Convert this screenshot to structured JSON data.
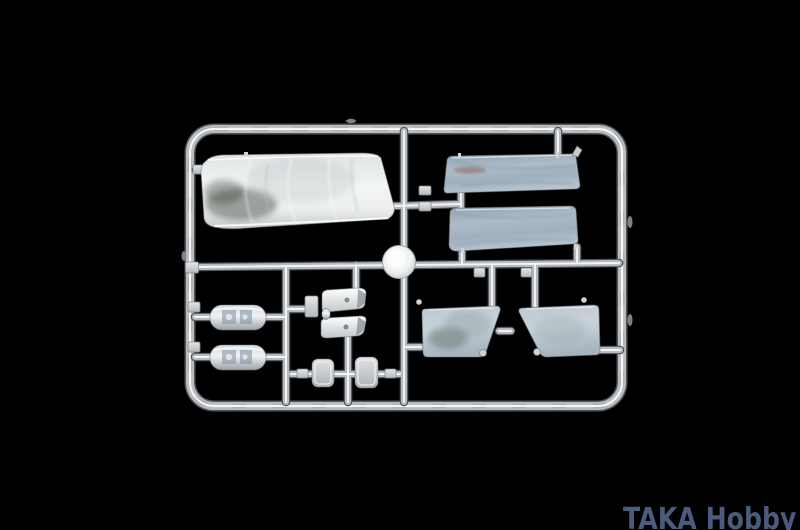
{
  "watermark": {
    "text": "TAKA Hobby"
  },
  "colors": {
    "background": "#000000",
    "watermark": "#4b5b7c",
    "plastic-base": "#b6babe",
    "plastic-highlight": "#f2f5f6",
    "glass-tint": "#a9b7c4",
    "window-tint": "#b9c6d1"
  },
  "photo": {
    "subject": "clear plastic model-kit sprue of transparent parts on black background",
    "parts": [
      "sprue-frame",
      "center-boss",
      "windshield",
      "upper-window-pane",
      "lower-window-pane",
      "lens-strip-top",
      "lens-strip-bottom",
      "visor-upper",
      "visor-lower",
      "glass-block-left",
      "glass-block-right",
      "side-window-left",
      "side-window-right"
    ]
  }
}
